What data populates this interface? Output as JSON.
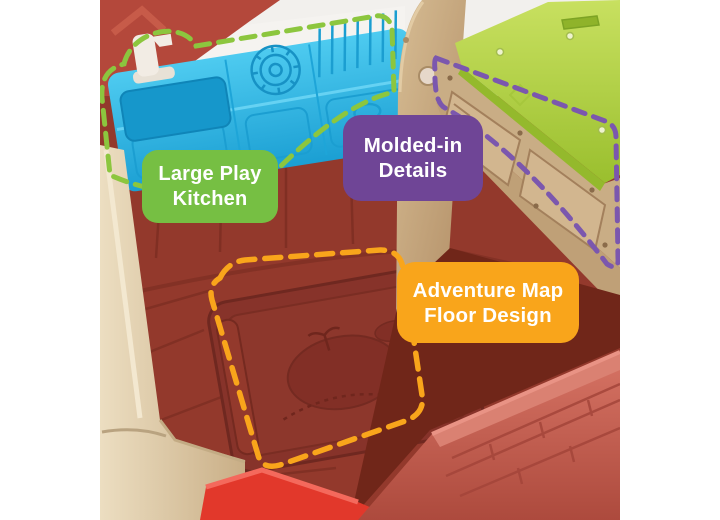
{
  "image": {
    "kind": "product-feature-photo",
    "subject": "toy playhouse interior with annotated features",
    "background": "#ffffff"
  },
  "annotations": [
    {
      "id": "large-play-kitchen",
      "lines": [
        "Large Play",
        "Kitchen"
      ],
      "label_color": "#76bf43",
      "text_color": "#ffffff",
      "outline_color": "#8cc63e",
      "outline_style": "dashed",
      "highlights": "blue toy kitchen unit with faucet, sink, burner and drainboard"
    },
    {
      "id": "molded-in-details",
      "lines": [
        "Molded-in",
        "Details"
      ],
      "label_color": "#6f4596",
      "text_color": "#ffffff",
      "outline_color": "#7b57ae",
      "outline_style": "dashed",
      "highlights": "tan molded drawer panels under the green counter"
    },
    {
      "id": "adventure-map-floor-design",
      "lines": [
        "Adventure Map",
        "Floor Design"
      ],
      "label_color": "#f9a51b",
      "text_color": "#ffffff",
      "outline_color": "#f9a51b",
      "outline_style": "dashed",
      "highlights": "embossed treasure-map panel in the dark red floor"
    }
  ],
  "photo_colors": {
    "kitchen_blue": "#2fb9e5",
    "counter_green": "#b8d643",
    "molded_tan": "#c9ad85",
    "floor_red": "#93392c",
    "gable_red": "#b4483b",
    "brick_wall_red": "#c05a4b",
    "slide_red": "#e2382b",
    "post_tan": "#dcc9a8"
  }
}
